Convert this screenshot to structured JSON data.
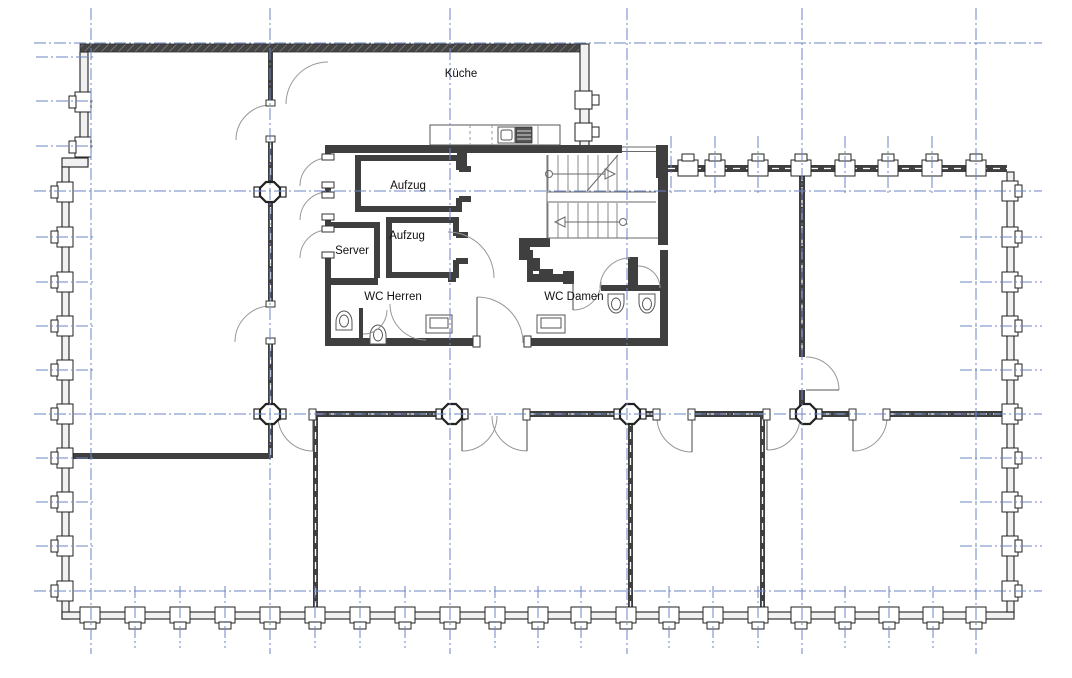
{
  "floor_plan": {
    "type": "architectural-floor-plan",
    "room_labels": {
      "kitchen": "Küche",
      "elevator_1": "Aufzug",
      "elevator_2": "Aufzug",
      "server_room": "Server",
      "wc_men": "WC Herren",
      "wc_women": "WC Damen"
    },
    "colors": {
      "background": "#ffffff",
      "grid_axis": "#6e86c5",
      "wall_dark": "#3f3f3f",
      "wall_fill_light": "#f1f1f1",
      "thin_lines": "#6a6a6a",
      "label_text": "#111111"
    }
  }
}
